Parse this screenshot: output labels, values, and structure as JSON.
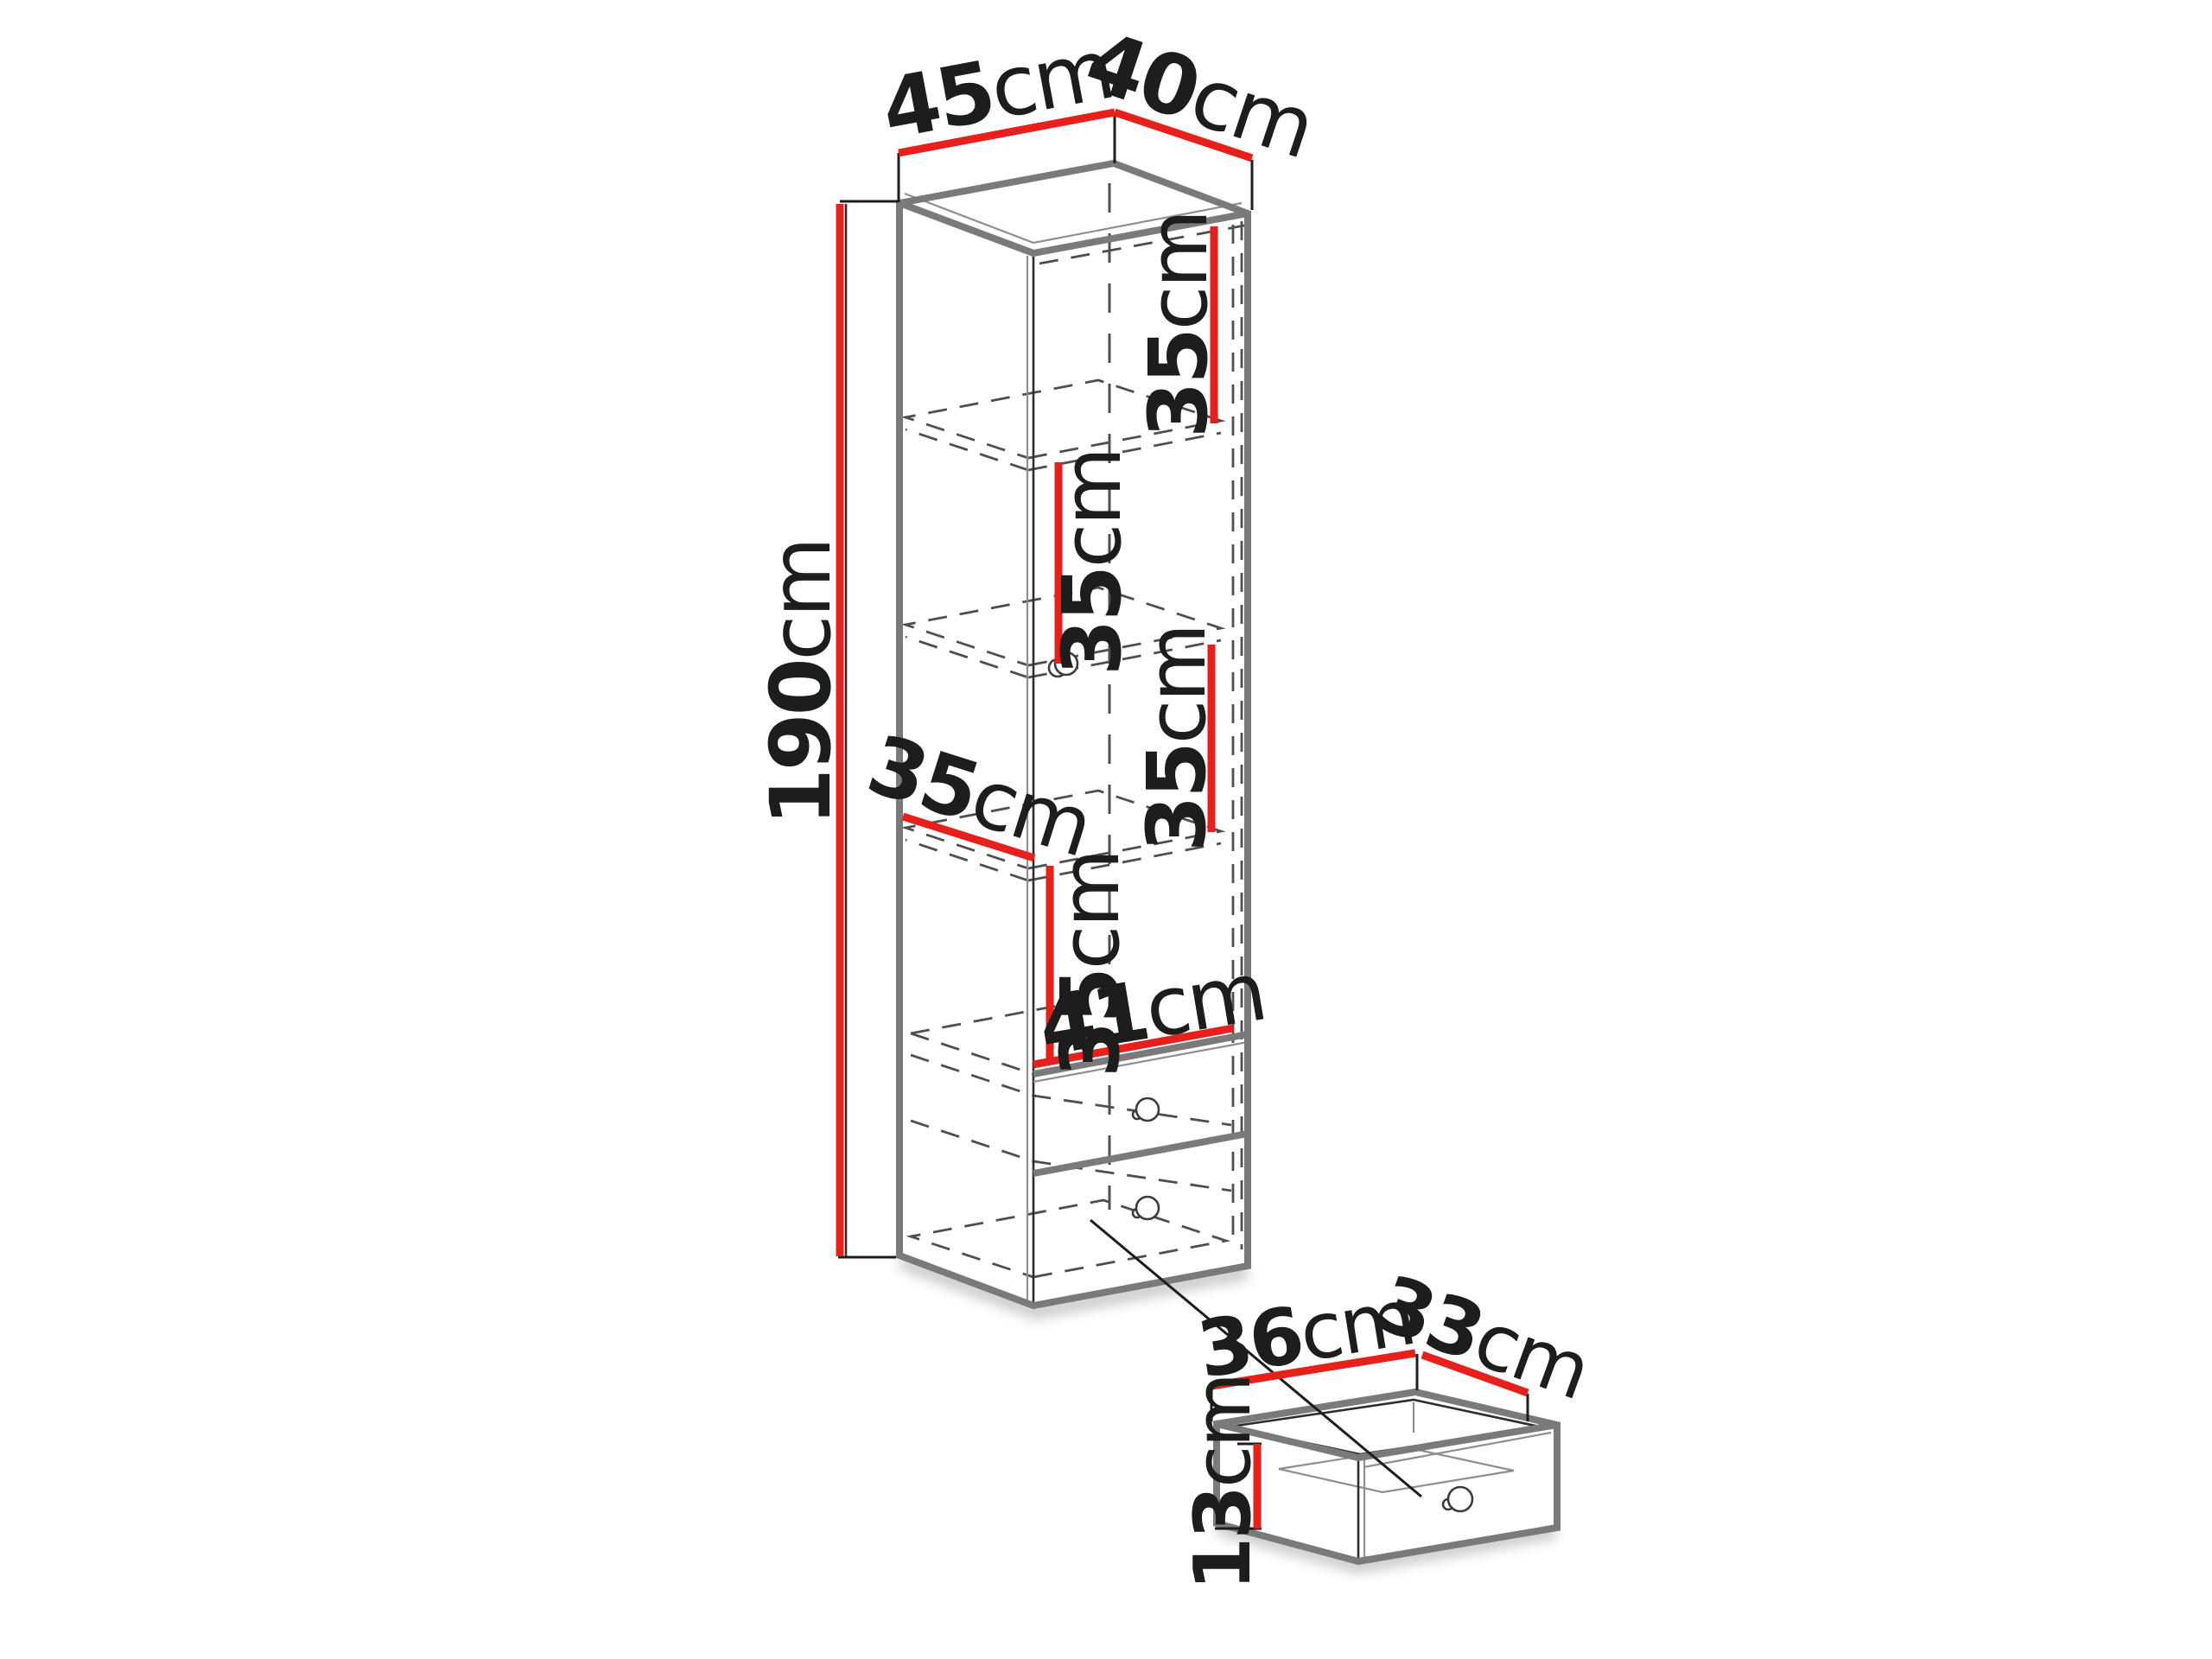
{
  "diagram": {
    "cabinet": {
      "width": {
        "value": "45",
        "unit": "cm"
      },
      "depth": {
        "value": "40",
        "unit": "cm"
      },
      "height": {
        "value": "190",
        "unit": "cm"
      },
      "compartments": [
        {
          "value": "35",
          "unit": "cm"
        },
        {
          "value": "35",
          "unit": "cm"
        },
        {
          "value": "35",
          "unit": "cm"
        },
        {
          "value": "35",
          "unit": "cm"
        }
      ],
      "shelf_depth": {
        "value": "35",
        "unit": "cm"
      },
      "interior_width": {
        "value": "41",
        "unit": "cm"
      }
    },
    "drawer": {
      "width": {
        "value": "36",
        "unit": "cm"
      },
      "depth": {
        "value": "33",
        "unit": "cm"
      },
      "height": {
        "value": "13",
        "unit": "cm"
      }
    },
    "colors": {
      "dimension_line": "#e8201c",
      "edge_gray": "#7a7a7a",
      "label_text": "#1d1d1b"
    }
  }
}
